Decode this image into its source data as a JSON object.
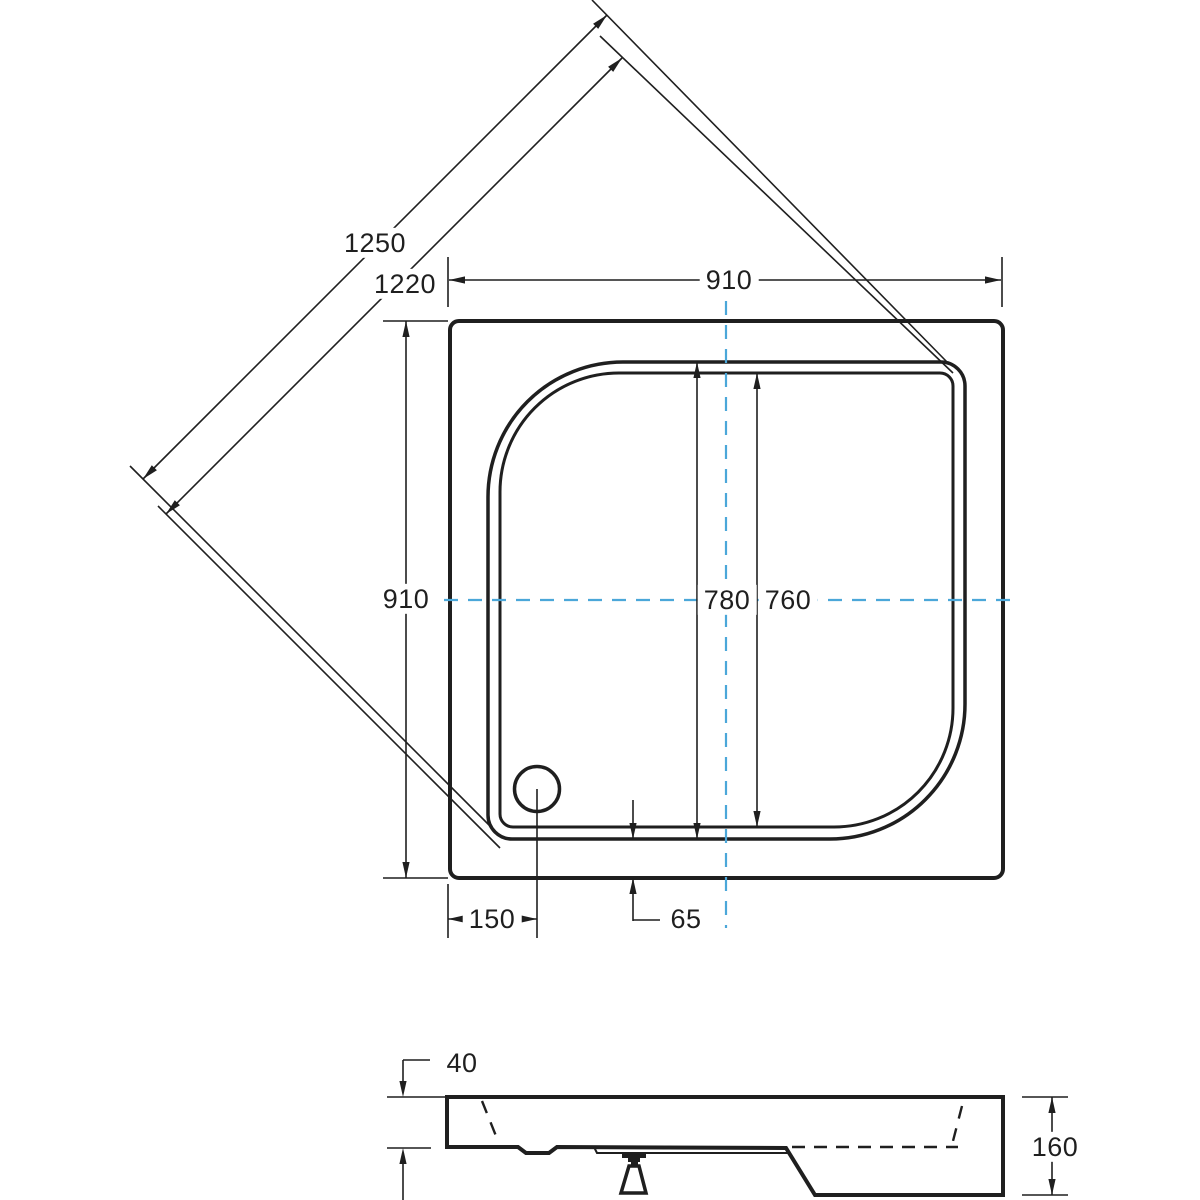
{
  "drawing": {
    "labels": {
      "diagonal_outer": "1250",
      "diagonal_inner": "1220",
      "outer_width": "910",
      "outer_depth": "910",
      "basin_width": "780",
      "basin_inner_width": "760",
      "drain_offset": "150",
      "rim_gap": "65",
      "rim_height": "40",
      "total_height": "160"
    },
    "colors": {
      "line": "#1f1f1f",
      "centerline": "#4ba7d9"
    }
  }
}
